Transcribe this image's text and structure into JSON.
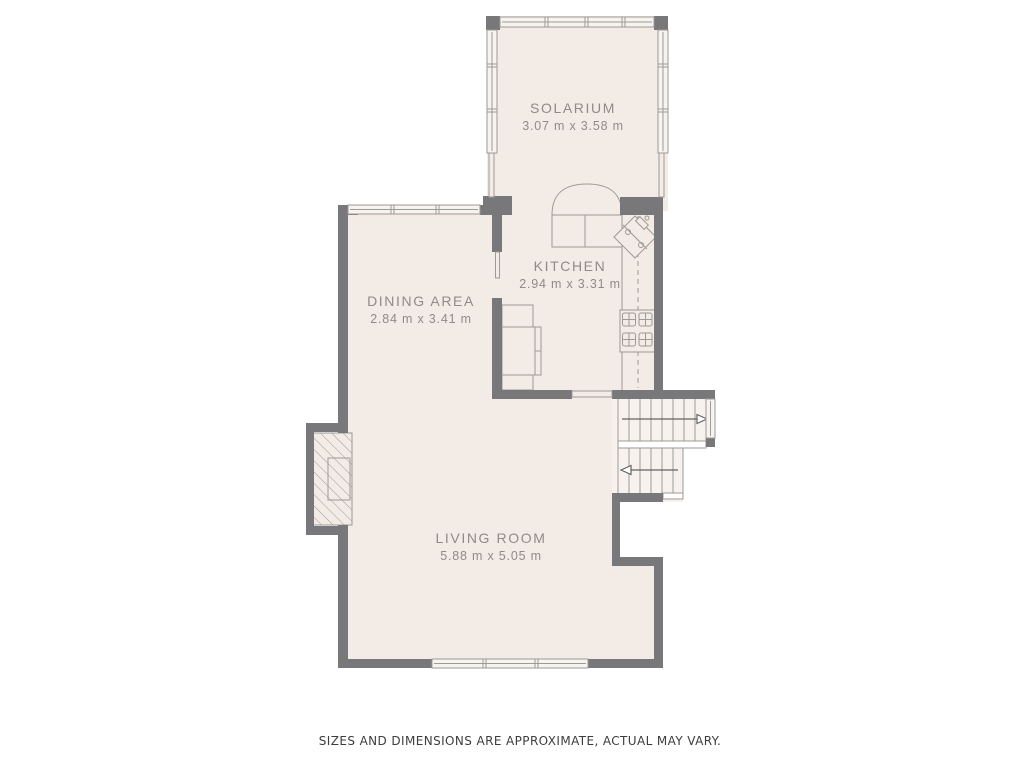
{
  "rooms": {
    "solarium": {
      "name": "SOLARIUM",
      "dims": "3.07 m x 3.58 m"
    },
    "kitchen": {
      "name": "KITCHEN",
      "dims": "2.94 m x 3.31 m"
    },
    "dining": {
      "name": "DINING AREA",
      "dims": "2.84 m x 3.41 m"
    },
    "living": {
      "name": "LIVING ROOM",
      "dims": "5.88 m x 5.05 m"
    }
  },
  "stairs": {
    "upper_arrow_direction": "right",
    "lower_arrow_direction": "left"
  },
  "footer": {
    "disclaimer": "SIZES AND DIMENSIONS ARE APPROXIMATE, ACTUAL MAY VARY."
  },
  "colors": {
    "background": "#ffffff",
    "wall": "#78777a",
    "floor": "#f2ebe6",
    "floor_light": "#f7f2ed",
    "line": "#9e9a95",
    "line_dark": "#636365",
    "text": "#8f8c88",
    "footer_text": "#3d3d3d",
    "window_fill": "#f7f3ef"
  }
}
